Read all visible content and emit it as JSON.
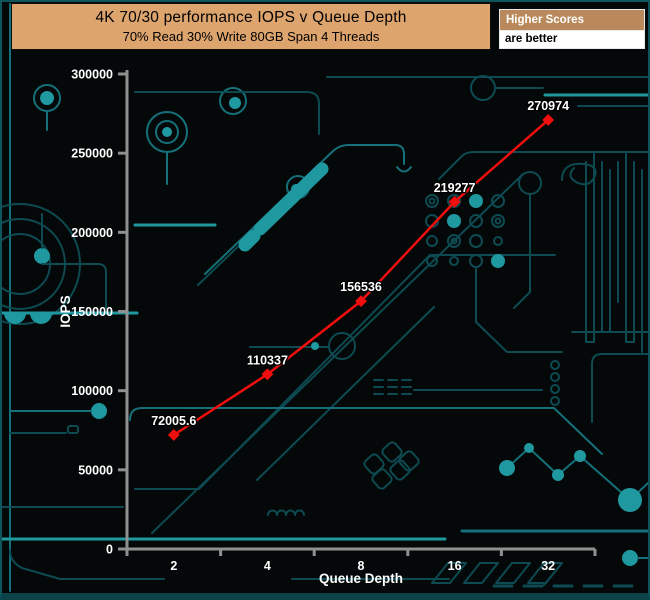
{
  "header": {
    "title_line1": "4K 70/30 performance IOPS v Queue Depth",
    "title_line2": "70% Read 30% Write 80GB Span 4 Threads"
  },
  "legend": {
    "heading": "Higher Scores",
    "subheading": "are better"
  },
  "chart_data": {
    "type": "line",
    "title": "4K 70/30 performance IOPS v Queue Depth",
    "subtitle": "70% Read 30% Write 80GB Span 4 Threads",
    "categories": [
      "2",
      "4",
      "8",
      "16",
      "32"
    ],
    "series": [
      {
        "name": "IOPS",
        "values": [
          72005.6,
          110337,
          156536,
          219277,
          270974
        ],
        "color": "#f10e0e",
        "marker": "diamond"
      }
    ],
    "point_labels": [
      "72005.6",
      "110337",
      "156536",
      "219277",
      "270974"
    ],
    "xlabel": "Queue Depth",
    "ylabel": "IOPS",
    "ylim": [
      0,
      300000
    ],
    "ytick_interval": 50000,
    "ytick_labels": [
      "0",
      "50000",
      "100000",
      "150000",
      "200000",
      "250000",
      "300000"
    ],
    "grid": false,
    "legend_position": "top-right-note"
  },
  "colors": {
    "background": "#040808",
    "circuit_dim": "#0d4a52",
    "circuit_mid": "#15707a",
    "circuit_bright": "#1f98a0",
    "axis": "#909090",
    "title_box_bg": "#dda46e",
    "legend_head_bg": "#b9895c",
    "series_line": "#f10e0e",
    "label_text": "#ffffff"
  }
}
